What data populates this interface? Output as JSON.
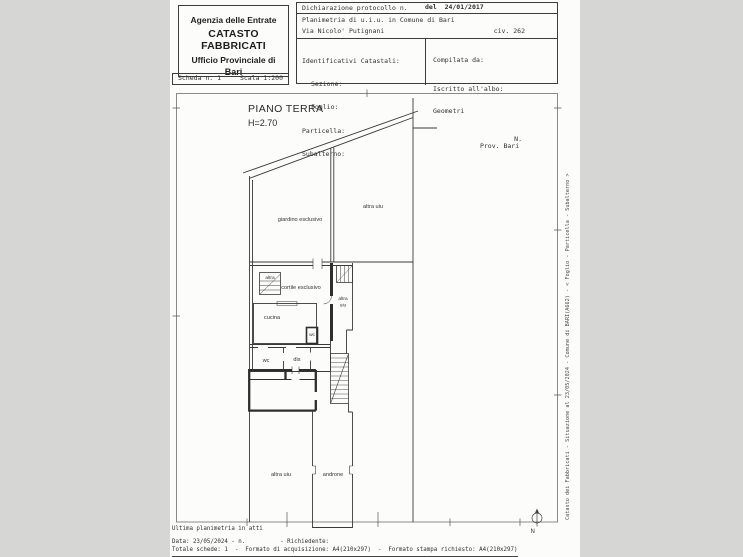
{
  "header": {
    "agency": {
      "line1": "Agenzia delle Entrate",
      "line2": "CATASTO FABBRICATI",
      "line3": "Ufficio Provinciale di",
      "line4": "Bari"
    },
    "scheda": {
      "label": "Scheda n. 1",
      "scale": "Scala 1:200"
    },
    "declaration": {
      "protocol": "Dichiarazione protocollo n.",
      "date": "del  24/01/2017",
      "planimetria": "Planimetria di u.i.u. in Comune di Bari",
      "street": "Via Nicolo' Putignani",
      "civic": "civ. 262"
    },
    "identifiers": {
      "title": "Identificativi Catastali:",
      "rows": [
        "Sezione:",
        "Foglio:",
        "Particella:",
        "Subalterno:"
      ]
    },
    "compiler": {
      "title": "Compilata da:",
      "register": "Iscritto all'albo:",
      "register2": "Geometri",
      "prov": "Prov. Bari",
      "n": "N."
    }
  },
  "plan": {
    "title": "PIANO TERRA",
    "height_label": "H=2.70",
    "rooms": {
      "giardino": "giardino esclusivo",
      "altra_top": "altra uiu",
      "altra_stair": "altra",
      "cortile": "cortile esclusivo",
      "altra_small_1": "altra",
      "altra_small_2": "uiu",
      "cucina": "cucina",
      "wc_small": "wc",
      "wc": "wc",
      "dis": "dis",
      "altra_corridor": "altra uiu",
      "androne": "androne"
    },
    "compass_label": "N"
  },
  "margin_note": "Catasto dei Fabbricati - Situazione al 23/05/2024 - Comune di BARI(A662) - <  Foglio  - Particella  - Subalterno  >",
  "footer": {
    "line1": "Ultima planimetria in atti",
    "line2": "Data: 23/05/2024 - n.          - Richiedente:",
    "line3": "Totale schede: 1  -  Formato di acquisizione: A4(210x297)  -  Formato stampa richiesto: A4(210x297)"
  }
}
